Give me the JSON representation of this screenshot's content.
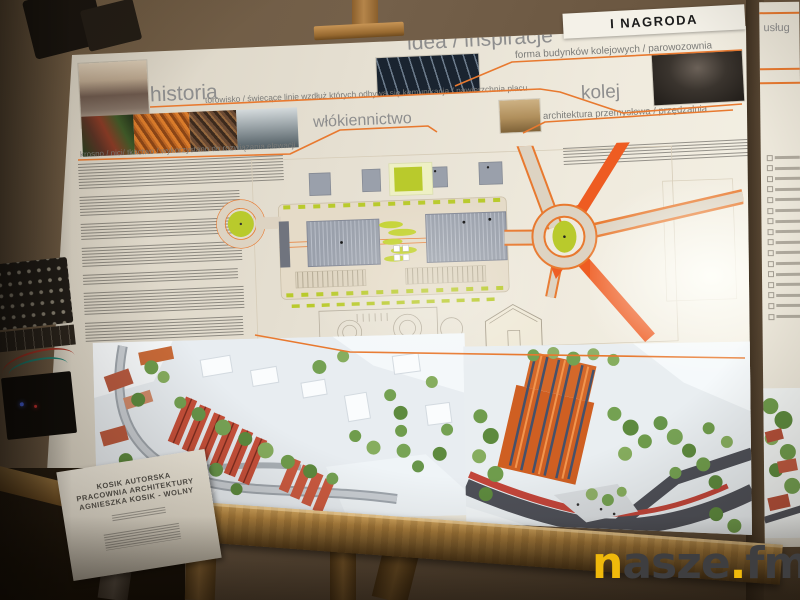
{
  "scene": {
    "award_label": "I NAGRODA",
    "watermark": {
      "n": "n",
      "asze": "asze",
      "dot": ".",
      "fm": "fm"
    }
  },
  "board": {
    "titles": {
      "idea": "idea / inspiracje",
      "historia": "historia",
      "wlokiennictwo": "włókiennictwo",
      "kolej": "kolej"
    },
    "captions": {
      "torowisko": "torowisko / świecące linie wzdłuż których odbywa się komunikacja / nawierzchnia placu",
      "forma": "forma budynków kolejowych / parowozownia",
      "architektura": "architektura przemysłowa / przędzalnia",
      "krosno": "krosno / nici/ tkactwo / wykorzystano do rozwiązania elewacji"
    },
    "credit_card": {
      "line1": "KOSIK AUTORSKA",
      "line2": "PRACOWNIA ARCHITEKTURY",
      "line3": "AGNIESZKA KOSIK - WOLNY"
    }
  },
  "side_board": {
    "fragment": "usług"
  },
  "colors": {
    "accent_orange": "#e8792f",
    "wall_brown": "#6b5741",
    "lime_green": "#b9ca2c",
    "roof_red": "#c7503a",
    "watermark_yellow": "#f0b90b"
  }
}
